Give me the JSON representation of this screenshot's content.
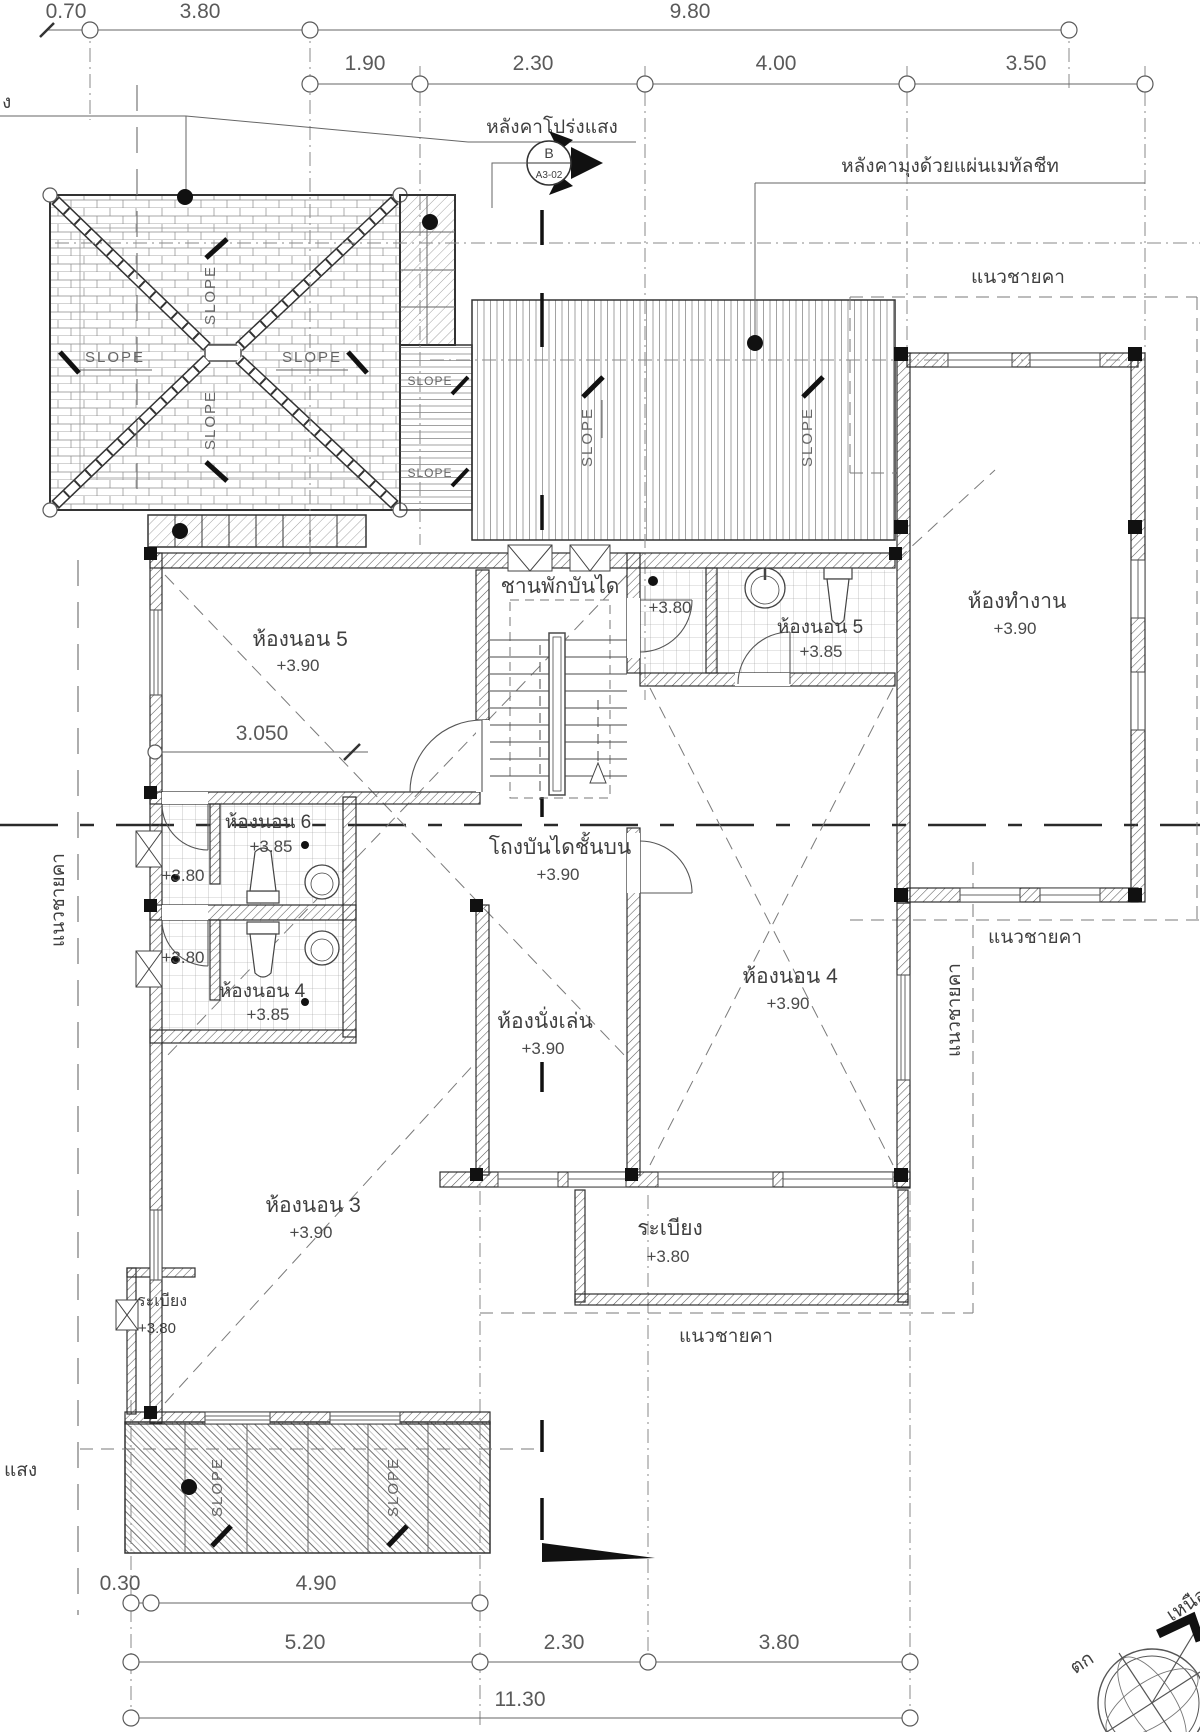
{
  "colors": {
    "ink": "#3f3f3f",
    "grid": "#8a8a8a",
    "bg": "#ffffff",
    "black": "#111111"
  },
  "dims": {
    "top1": [
      "0.70",
      "3.80",
      "9.80"
    ],
    "top2": [
      "1.90",
      "2.30",
      "4.00",
      "3.50"
    ],
    "mid": "3.050",
    "botA": [
      "0.30",
      "4.90"
    ],
    "botB": [
      "5.20",
      "2.30",
      "3.80"
    ],
    "botC": "11.30"
  },
  "notes": {
    "translucent_roof": "หลังคาโปร่งแสง",
    "metal_roof": "หลังคามุงด้วยแผ่นเมทัลชีท",
    "eave_line": "แนวชายคา",
    "slope": "SLOPE",
    "partial_top": "ง",
    "partial_left": "แสง"
  },
  "section_marker": {
    "letter": "B",
    "sheet": "A3-02"
  },
  "rooms": {
    "stair_landing": {
      "name": "ชานพักบันได"
    },
    "bath_top": {
      "elev_wet": "+3.80",
      "name": "ห้องนอน 5",
      "elev": "+3.85"
    },
    "office": {
      "name": "ห้องทำงาน",
      "elev": "+3.90"
    },
    "bedroom5": {
      "name": "ห้องนอน 5",
      "elev": "+3.90"
    },
    "stair_hall": {
      "name": "โถงบันไดชั้นบน",
      "elev": "+3.90"
    },
    "bath_6": {
      "name": "ห้องนอน 6",
      "elev": "+3.85",
      "elev_wet": "+3.80"
    },
    "bath_4": {
      "name": "ห้องนอน 4",
      "elev": "+3.85",
      "elev_wet": "+3.80"
    },
    "living": {
      "name": "ห้องนั่งเล่น",
      "elev": "+3.90"
    },
    "bedroom4": {
      "name": "ห้องนอน 4",
      "elev": "+3.90"
    },
    "bedroom3": {
      "name": "ห้องนอน 3",
      "elev": "+3.90"
    },
    "balcony_right": {
      "name": "ระเบียง",
      "elev": "+3.80"
    },
    "balcony_left": {
      "name": "ระเบียง",
      "elev": "+3.80"
    }
  },
  "compass": {
    "west": "ตก",
    "north": "เหนือ"
  }
}
